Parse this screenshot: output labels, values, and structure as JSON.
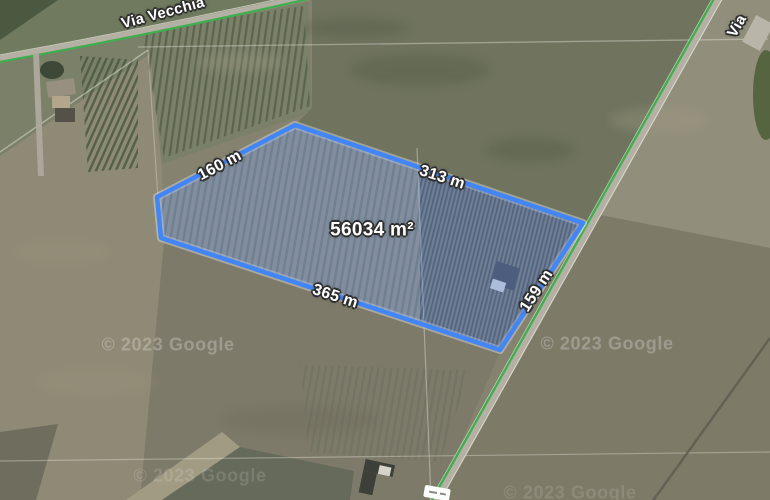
{
  "map": {
    "road_labels": [
      {
        "name": "Via Vecchia"
      },
      {
        "name": "Via"
      }
    ],
    "attribution": "© 2023 Google",
    "cycle_route_color": "#3fae4e"
  },
  "measurement": {
    "area_label": "56034 m²",
    "edge_labels": [
      "160 m",
      "313 m",
      "365 m",
      "159 m"
    ],
    "stroke_color": "#4285F4",
    "fill_color": "rgba(125,160,235,0.38)"
  }
}
